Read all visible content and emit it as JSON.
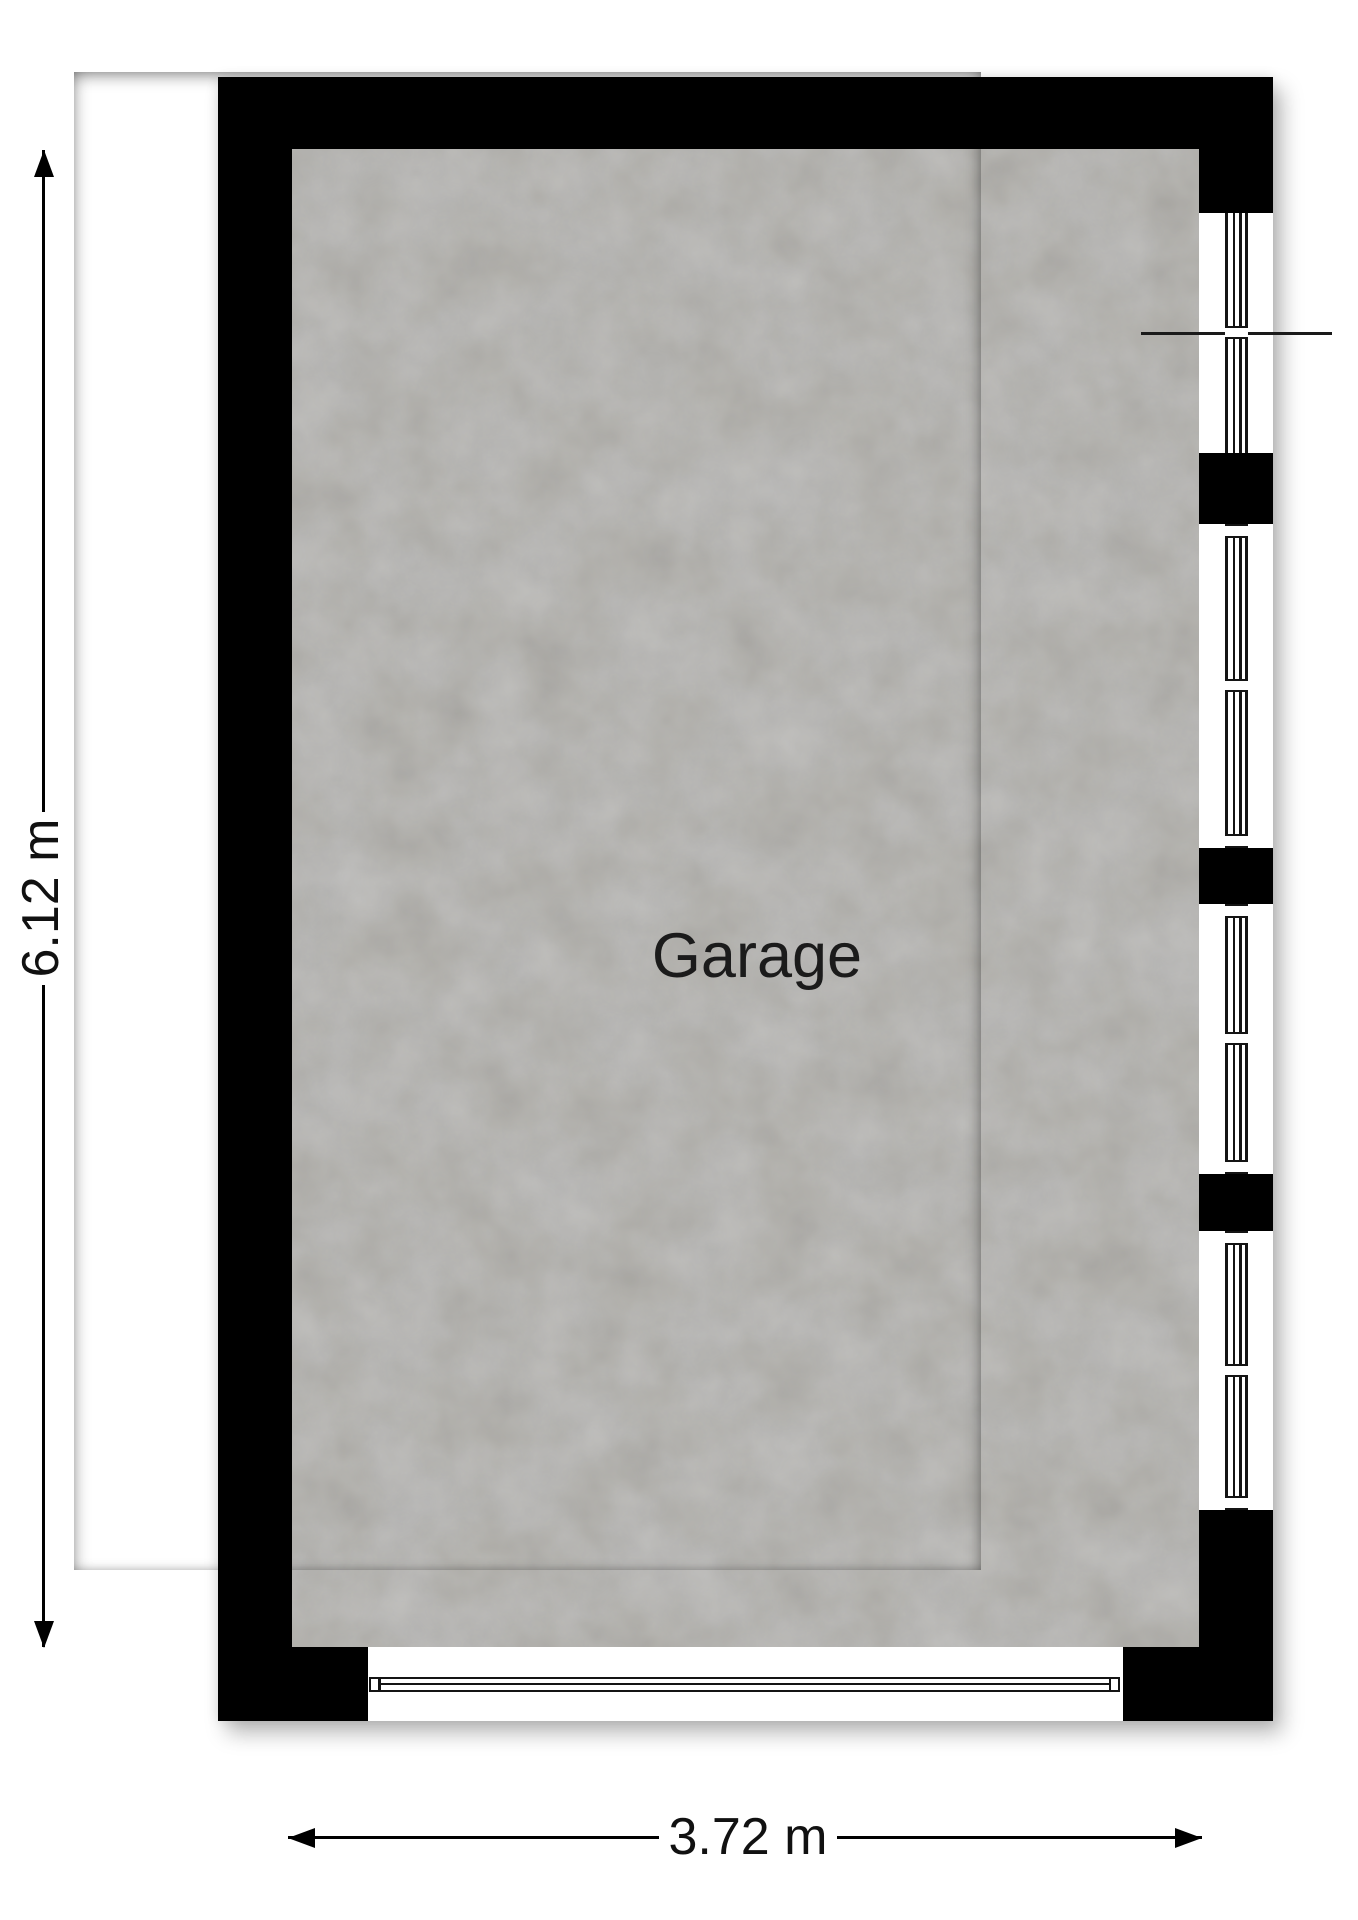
{
  "floorplan": {
    "room_label": "Garage",
    "vertical_dimension_label": "6.12 m",
    "horizontal_dimension_label": "3.72 m",
    "features": {
      "right_wall_window_count": 4,
      "bottom_garage_door": true,
      "window_callout_line": true
    },
    "colors": {
      "wall": "#000000",
      "floor": "#a19f99",
      "background": "#ffffff",
      "line": "#141414"
    }
  }
}
